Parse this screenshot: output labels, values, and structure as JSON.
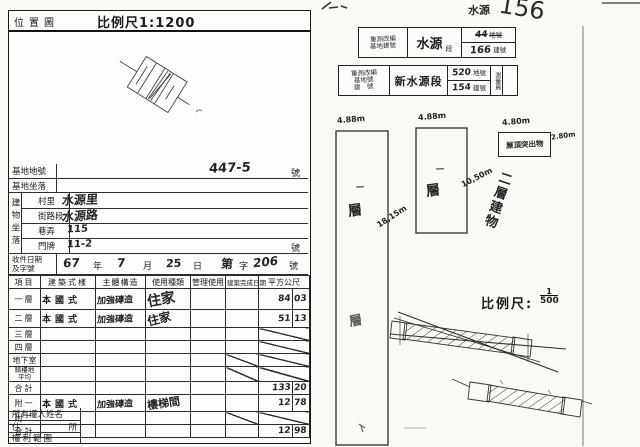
{
  "left_form": {
    "map": {
      "title": "位置圖",
      "scale": "比例尺1:1200"
    },
    "fields": {
      "site_no_label": "基地地號",
      "site_no_value": "447-5",
      "site_no_unit": "號",
      "site_loc_label": "基地坐落",
      "building_loc_group": "建物坐落",
      "village_label": "村里",
      "village_value": "水源里",
      "street_label": "街路段",
      "street_value": "水源路",
      "lane_label": "巷弄",
      "lane_value": "115",
      "door_label": "門牌",
      "door_value": "11-2",
      "door_unit": "號",
      "receipt_label1": "收件日期",
      "receipt_label2": "及字號",
      "receipt": {
        "y": "67",
        "y_unit": "年",
        "m": "7",
        "m_unit": "月",
        "d": "25",
        "d_unit": "日",
        "word1": "第",
        "word2": "字",
        "no": "206",
        "no_unit": "號"
      }
    },
    "table": {
      "headers": [
        "項目",
        "建築式樣",
        "主體構造",
        "使用種類",
        "管理使用",
        "建築完成日期",
        "平方公尺"
      ],
      "rows": [
        {
          "label": "一層",
          "style": "本國式",
          "structure": "加強磚造",
          "use": "住家",
          "sq_int": "84",
          "sq_dec": "03"
        },
        {
          "label": "二層",
          "style": "本國式",
          "structure": "加強磚造",
          "use": "住家",
          "sq_int": "51",
          "sq_dec": "13"
        },
        {
          "label": "三層"
        },
        {
          "label": "四層"
        },
        {
          "label": "地下室"
        },
        {
          "label1": "騎樓地",
          "label2": "平均"
        },
        {
          "label": "合計",
          "sq_int": "133",
          "sq_dec": "20"
        },
        {
          "label": "附一",
          "style": "本國式",
          "structure": "加強磚造",
          "use": "樓梯間",
          "sq_int": "12",
          "sq_dec": "78"
        },
        {
          "label": "附二"
        },
        {
          "label": "合計",
          "sq_int": "12",
          "sq_dec": "98"
        }
      ]
    },
    "owner": {
      "name_label": "所有權人姓名",
      "addr_label1": "住",
      "addr_label2": "所",
      "rights_label": "權利範圍"
    }
  },
  "right_page": {
    "corner_note": {
      "word": "水源",
      "number": "156"
    },
    "stamp_small": {
      "c1_line1": "重測改編",
      "c1_line2": "基地建號",
      "c2_main": "水源",
      "c2_unit": "段",
      "r1_num": "44",
      "r1_label": "地號",
      "r2_num": "166",
      "r2_label": "建號"
    },
    "stamp_large": {
      "c1_line1": "重測改編",
      "c1_line2": "基地號",
      "c1_line3": "建　號",
      "c2_main": "新水源段",
      "r1_num": "520",
      "r1_label": "地號",
      "r2_num": "154",
      "r2_label": "建號",
      "c4": "測量員"
    },
    "sketch": {
      "b1_dim_top": "4.88m",
      "b1_dim_side": "18,15m",
      "b1_mark": "一",
      "b1_floor": "層",
      "b1_floor2": "層",
      "b2_dim_top": "4.88m",
      "b2_dim_side": "10,50m",
      "b2_mark": "一",
      "b2_floor": "層",
      "roof_box_text": "屋頂突出物",
      "roof_dim_top": "4.80m",
      "roof_dim_side": "2.80m",
      "note_vertical": "二層建物"
    },
    "scale": {
      "label": "比例尺:",
      "numerator": "1",
      "denominator": "500"
    }
  }
}
